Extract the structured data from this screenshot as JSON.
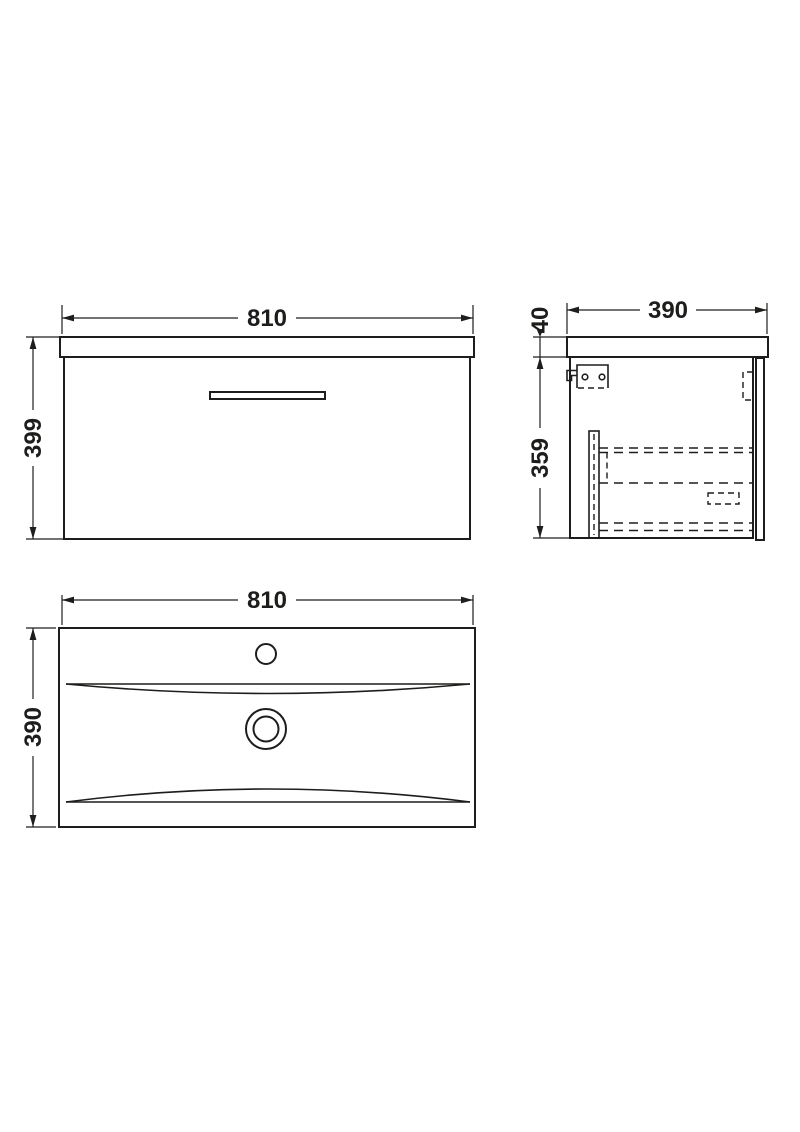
{
  "colors": {
    "line": "#1d1d1b",
    "background": "#ffffff"
  },
  "views": {
    "front": {
      "width_label": "810",
      "height_label": "399"
    },
    "side": {
      "depth_label": "390",
      "worktop_thickness_label": "40",
      "cabinet_height_label": "359"
    },
    "basin": {
      "width_label": "810",
      "depth_label": "390"
    }
  }
}
